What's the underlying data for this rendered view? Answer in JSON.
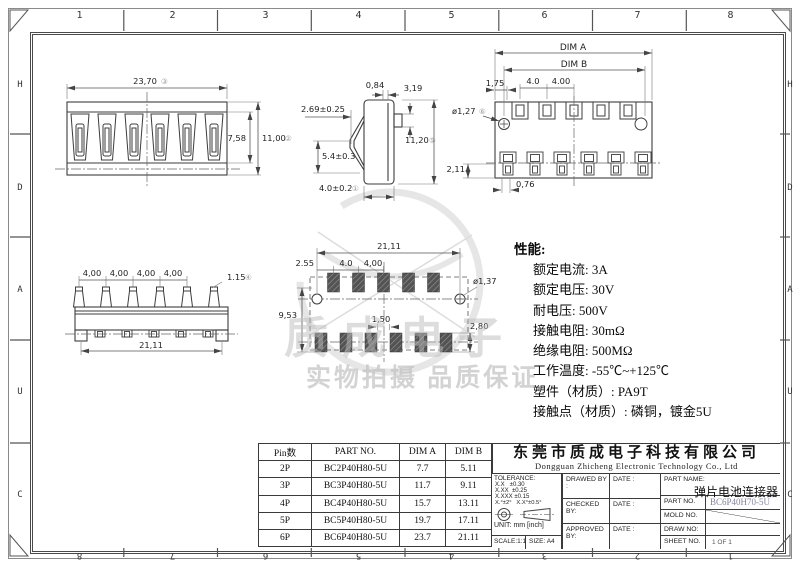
{
  "frame": {
    "cols": [
      "1",
      "2",
      "3",
      "4",
      "5",
      "6",
      "7",
      "8"
    ],
    "cols_rev": [
      "8",
      "7",
      "6",
      "5",
      "4",
      "3",
      "2",
      "1"
    ],
    "rows": [
      "H",
      "D",
      "A",
      "U",
      "C"
    ]
  },
  "dims": {
    "front_w": "23,70",
    "front_w_mk": "③",
    "front_h1": "7,58",
    "front_h2": "11,00",
    "front_h2_mk": "②",
    "side_t": "0,84",
    "side_tr": "3,19",
    "side_l": "2.69±0.25",
    "side_h": "11,20",
    "side_h_mk": "⑤",
    "side_arm": "5.4±0.3",
    "side_b": "4.0±0.2",
    "side_b_mk": "①",
    "top_a": "DIM A",
    "top_b": "DIM B",
    "top_p1": "4.0",
    "top_p2": "4.00",
    "top_l": "1,75",
    "top_hole": "ø1,27",
    "top_hole_mk": "⑥",
    "top_bl": "2,11",
    "top_bw": "0,76",
    "bot_p": "4,00",
    "bot_pin": "1.15",
    "bot_pin_mk": "④",
    "bot_w": "21,11",
    "pcb_w": "21,11",
    "pcb_l": "2.55",
    "pcb_p1": "4.0",
    "pcb_p2": "4,00",
    "pcb_h": "9,53",
    "pcb_hole": "ø1,37",
    "pcb_pad": "1,50",
    "pcb_pad_h": "2,80"
  },
  "specs": {
    "title": "性能:",
    "lines": [
      "额定电流: 3A",
      "额定电压: 30V",
      "耐电压: 500V",
      "接触电阻: 30mΩ",
      "绝缘电阻: 500MΩ",
      "工作温度: -55℃~+125℃",
      "塑件（材质）: PA9T",
      "接触点（材质）: 磷铜，镀金5U"
    ]
  },
  "table": {
    "headers": [
      "Pin数",
      "PART NO.",
      "DIM A",
      "DIM B"
    ],
    "rows": [
      [
        "2P",
        "BC2P40H80-5U",
        "7.7",
        "5.11"
      ],
      [
        "3P",
        "BC3P40H80-5U",
        "11.7",
        "9.11"
      ],
      [
        "4P",
        "BC4P40H80-5U",
        "15.7",
        "13.11"
      ],
      [
        "5P",
        "BC5P40H80-5U",
        "19.7",
        "17.11"
      ],
      [
        "6P",
        "BC6P40H80-5U",
        "23.7",
        "21.11"
      ]
    ]
  },
  "title_block": {
    "company_cn": "东莞市质成电子科技有限公司",
    "company_en": "Dongguan Zhicheng Electronic Technology Co., Ltd",
    "tolerance_title": "TOLERANCE:",
    "tol1": "X.X   ±0.30",
    "tol2": "X.XX  ±0.25",
    "tol3": "X.XXX ±0.15",
    "tol_angle": "X.°±2°   X.X°±0.5°",
    "unit": "UNIT: mm [inch]",
    "scale": "SCALE:1:1",
    "size": "SIZE: A4",
    "drawed_by": "DRAWED BY :",
    "checked_by": "CHECKED BY:",
    "approved_by": "APPROVED BY:",
    "date": "DATE :",
    "part_name_label": "PART NAME:",
    "part_name": "弹片电池连接器",
    "part_no_label": "PART NO.",
    "part_no": "BC6P40H70-5U",
    "mold_no_label": "MOLD NO.",
    "draw_no_label": "DRAW NO:",
    "sheet_no_label": "SHEET NO.",
    "sheet_no": "1 OF 1"
  },
  "watermark": {
    "logo_text": "质成电子",
    "slogan": "实物拍摄 品质保证"
  }
}
